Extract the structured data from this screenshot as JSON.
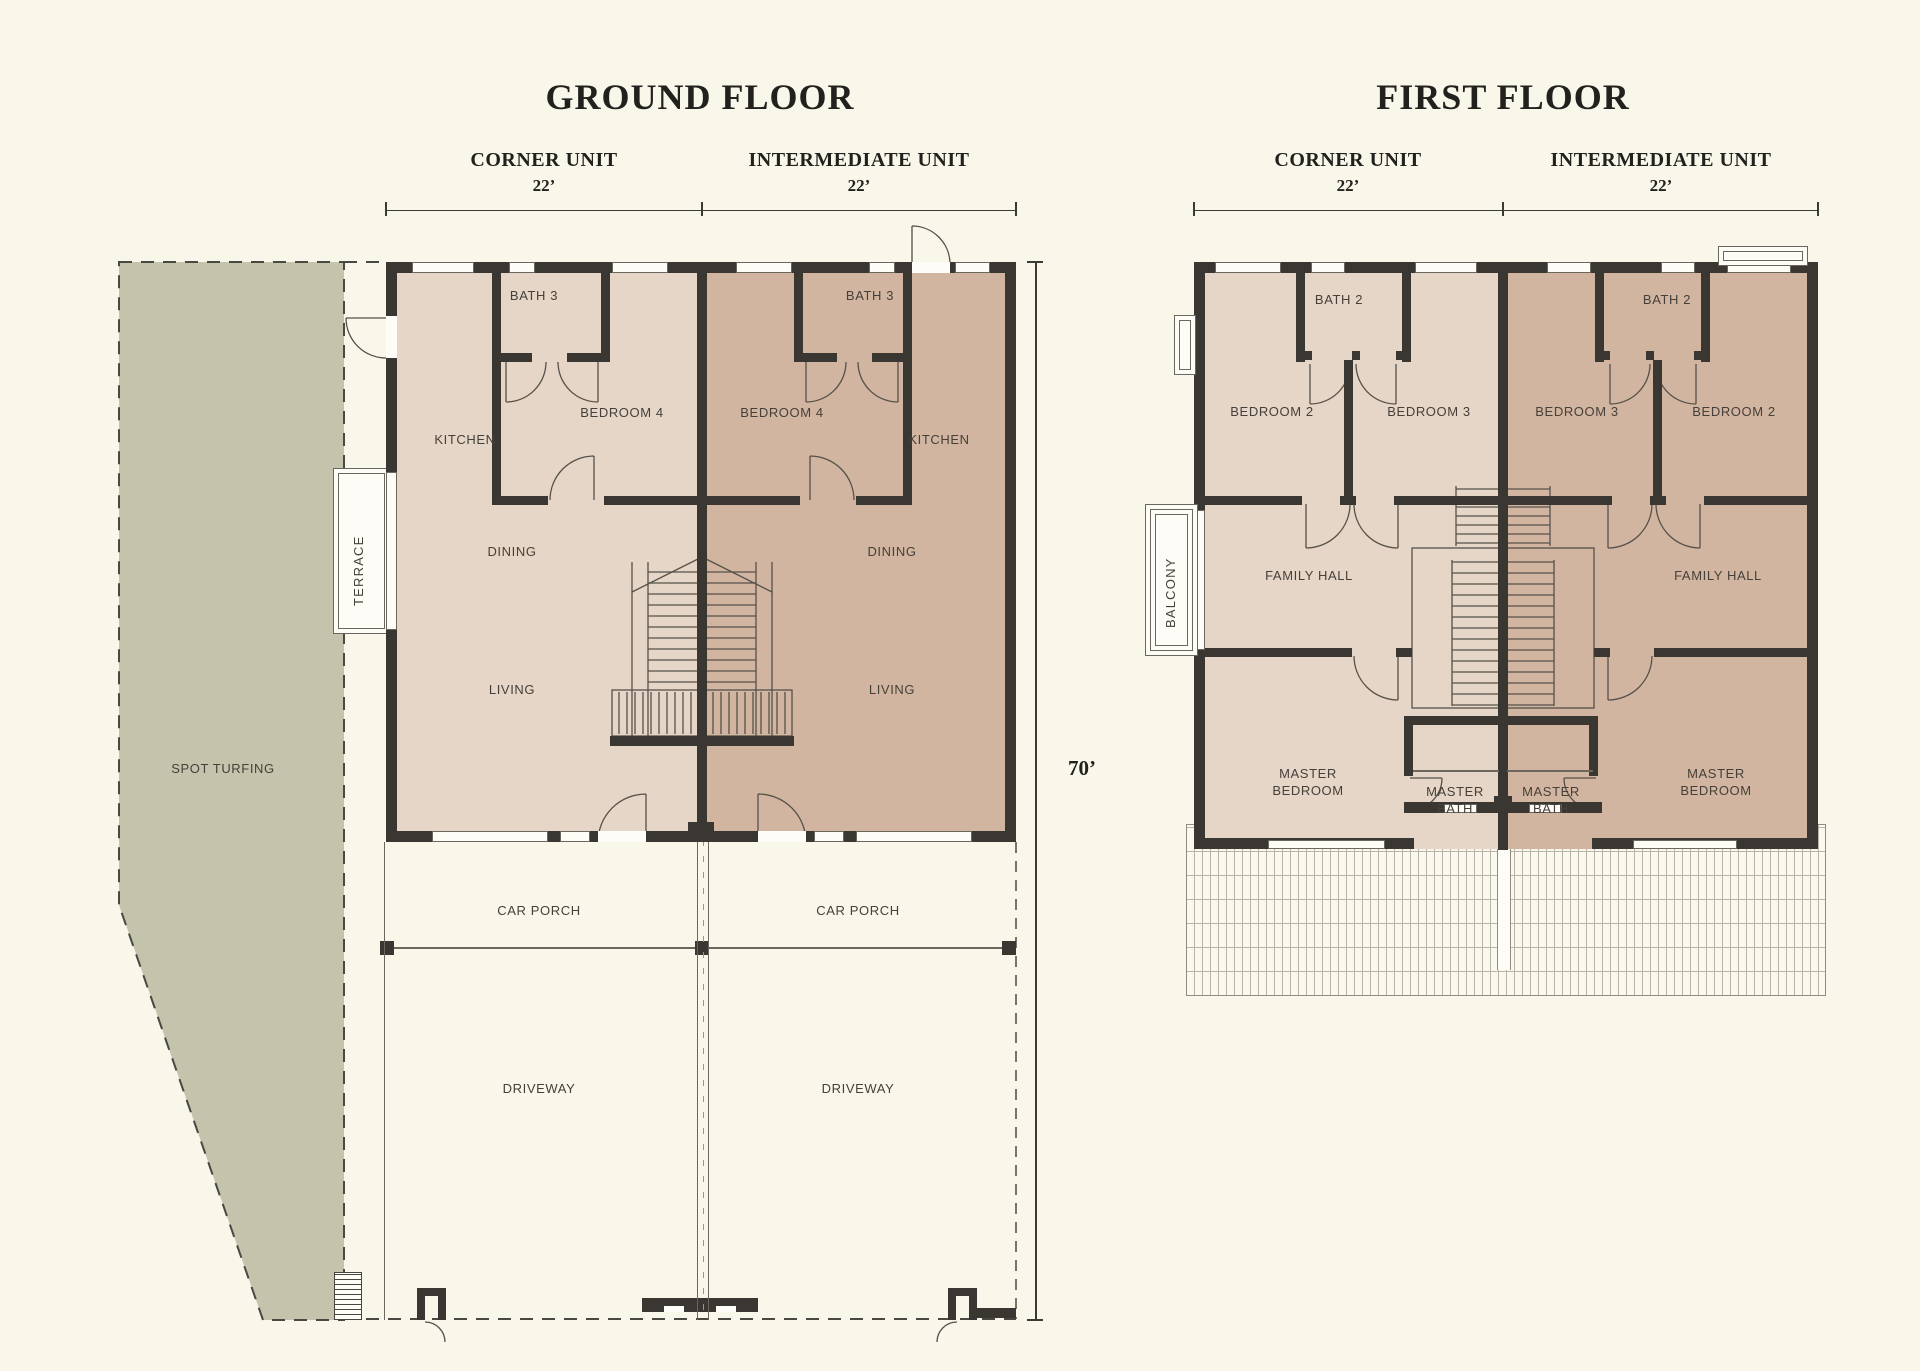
{
  "palette": {
    "background": "#f9f6ea",
    "corner_unit_fill": "#e6d6c7",
    "intermediate_unit_fill": "#d2b5a0",
    "spot_turfing_fill": "#c3c4ab",
    "wall": "#3a3631",
    "line": "#55514a",
    "title_text": "#23211d",
    "room_text": "#454039"
  },
  "ground_floor": {
    "title": "GROUND FLOOR",
    "units": {
      "corner": "CORNER UNIT",
      "corner_width": "22’",
      "intermediate": "INTERMEDIATE UNIT",
      "intermediate_width": "22’"
    },
    "depth_dim": "70’",
    "rooms": {
      "bath": "BATH 3",
      "bedroom": "BEDROOM 4",
      "kitchen": "KITCHEN",
      "dining": "DINING",
      "living": "LIVING",
      "car_porch": "CAR PORCH",
      "driveway": "DRIVEWAY"
    },
    "site": {
      "spot_turfing": "SPOT TURFING",
      "terrace": "TERRACE"
    }
  },
  "first_floor": {
    "title": "FIRST FLOOR",
    "units": {
      "corner": "CORNER UNIT",
      "corner_width": "22’",
      "intermediate": "INTERMEDIATE UNIT",
      "intermediate_width": "22’"
    },
    "rooms": {
      "bath": "BATH 2",
      "bedroom2": "BEDROOM 2",
      "bedroom3": "BEDROOM 3",
      "family_hall": "FAMILY HALL",
      "master_bedroom": "MASTER\nBEDROOM",
      "master_bath": "MASTER\nBATH",
      "balcony": "BALCONY"
    }
  }
}
